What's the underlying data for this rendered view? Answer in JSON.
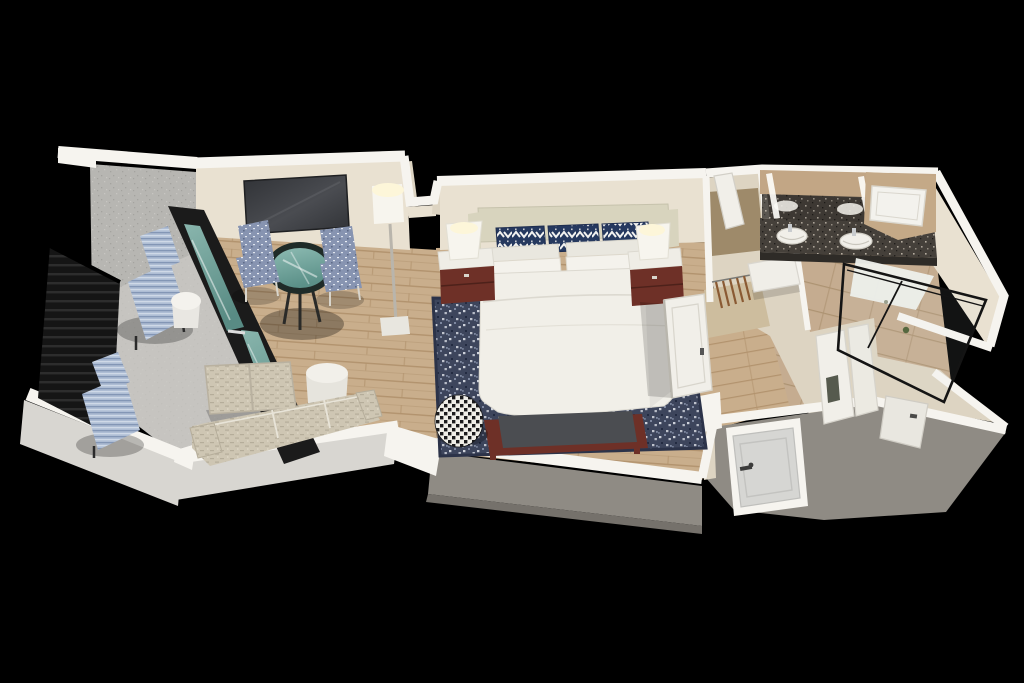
{
  "meta": {
    "description": "3D isometric cutaway rendering of a hotel suite floor plan on a black background",
    "background": "#000000"
  },
  "palette": {
    "bg": "#000000",
    "wall_cap": "#f6f4ef",
    "wall_cream": "#e9e1d1",
    "wall_cream_dark": "#ddd4c2",
    "parapet_face": "#d8d6d1",
    "ext_gray": "#8f8b84",
    "ext_gray_dark": "#75716b",
    "stucco": "#b7b6b2",
    "stucco_dot_dark": "#a4a39f",
    "stucco_dot_light": "#c7c6c2",
    "balcony_floor": "#cbc9c4",
    "railing_dark": "#151515",
    "railing_slat": "#2d2d2d",
    "wood": "#c9ae8c",
    "wood_line": "#b2936e",
    "tile": "#c5ac90",
    "tile_line": "#ad9372",
    "carpet_tan": "#cdbd9e",
    "closet_recess": "#9e8a6a",
    "rug_base": "#3d455c",
    "rug_fleck_light": "#cdd1da",
    "rug_fleck_mid": "#7e88a0",
    "rug_fleck_dark": "#232b41",
    "rug_border": "#2c3349",
    "bed_linen": "#f1efe8",
    "headboard": "#d8d4be",
    "pillow_navy": "#26395f",
    "pillow_white": "#f4f2ec",
    "maroon": "#6e3027",
    "bench_top": "#4b4d51",
    "sofa_base": "#cec6b3",
    "sofa_line": "#b5ad9a",
    "chair_base": "#8794b1",
    "chair_fleck": "#e9edf4",
    "glass_teal_light": "#93c3ba",
    "glass_teal_dark": "#5e958d",
    "glass_frame": "#141414",
    "tv_dark": "#303236",
    "tv_light": "#4a4c51",
    "lamp_glow": "#fdf6d9",
    "lamp_white": "#f7f5ee",
    "granite": "#45403a",
    "granite_fleck_light": "#b6ada0",
    "granite_fleck_dark": "#211e1b",
    "sink_white": "#f1efe9",
    "door_gray": "#d6d6d3",
    "door_white": "#f1efe9",
    "mirror_tan": "#c2a685",
    "hanger_brown": "#8a5a33",
    "towel_dark": "#565a4e",
    "plant_green": "#55683f"
  },
  "scene": {
    "rooms": [
      {
        "id": "balcony",
        "label": "balcony",
        "furniture": [
          "chaise-lounge",
          "chaise-lounge",
          "round-side-table",
          "metal-railing",
          "parapet-wall"
        ]
      },
      {
        "id": "living-room",
        "label": "living room",
        "furniture": [
          "wall-tv",
          "floor-lamp",
          "glass-bistro-table",
          "upholstered-chair",
          "upholstered-chair",
          "ottoman",
          "sofa",
          "round-side-table",
          "sliding-glass-door"
        ]
      },
      {
        "id": "bedroom",
        "label": "bedroom",
        "furniture": [
          "king-bed",
          "headboard",
          "accent-pillows",
          "nightstand",
          "nightstand",
          "table-lamp",
          "table-lamp",
          "foot-bench",
          "patterned-pouf",
          "area-rug",
          "swing-door"
        ]
      },
      {
        "id": "closet",
        "label": "closet",
        "furniture": [
          "clothes-hangers",
          "shelf",
          "luggage-rack"
        ]
      },
      {
        "id": "hallway",
        "label": "entry hallway",
        "furniture": [
          "entry-door"
        ]
      },
      {
        "id": "bathroom",
        "label": "bathroom",
        "furniture": [
          "double-vanity",
          "sink",
          "sink",
          "mirror",
          "bathtub",
          "glass-shower"
        ]
      },
      {
        "id": "toilet-room",
        "label": "toilet room",
        "furniture": [
          "door",
          "towel-hook"
        ]
      }
    ]
  }
}
